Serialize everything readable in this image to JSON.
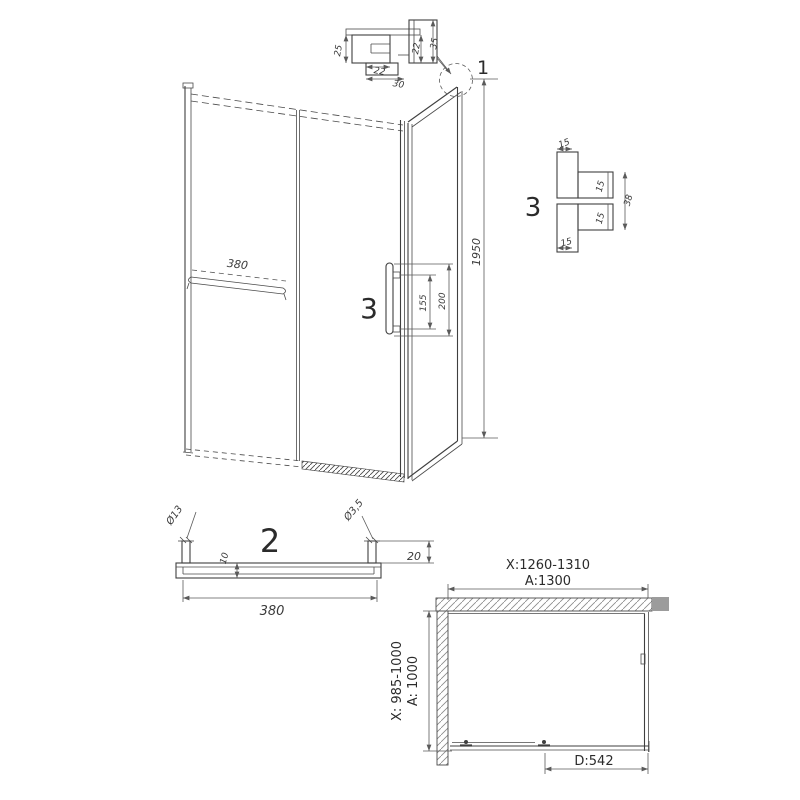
{
  "front_view": {
    "callout_1": "1",
    "callout_3": "3",
    "height": "1950",
    "towel_bar_length": "380",
    "handle_dim_inner": "155",
    "handle_dim_outer": "200"
  },
  "detail_1": {
    "dim_left": "25",
    "dim_bottom_inner": "22",
    "dim_bottom_outer": "30",
    "dim_right_inner": "22",
    "dim_right_outer": "35"
  },
  "detail_3": {
    "label": "3",
    "dim_top": "15",
    "dim_upper_right": "15",
    "dim_overall": "38",
    "dim_lower_right": "15",
    "dim_bottom": "15"
  },
  "view_2": {
    "label": "2",
    "bar_diameter": "Ø13",
    "hole_diameter": "Ø3,5",
    "profile_height": "10",
    "end_offset": "20",
    "length": "380"
  },
  "plan_view": {
    "width_range": "X:1260-1310",
    "width_nominal": "A:1300",
    "depth_range": "X: 985-1000",
    "depth_nominal": "A: 1000",
    "door_width": "D:542"
  },
  "colors": {
    "line": "#3f3f3f",
    "dim": "#5a5a5a",
    "wall_fill": "#9c9c9c",
    "hatch": "#8a8a8a",
    "background": "#ffffff"
  }
}
